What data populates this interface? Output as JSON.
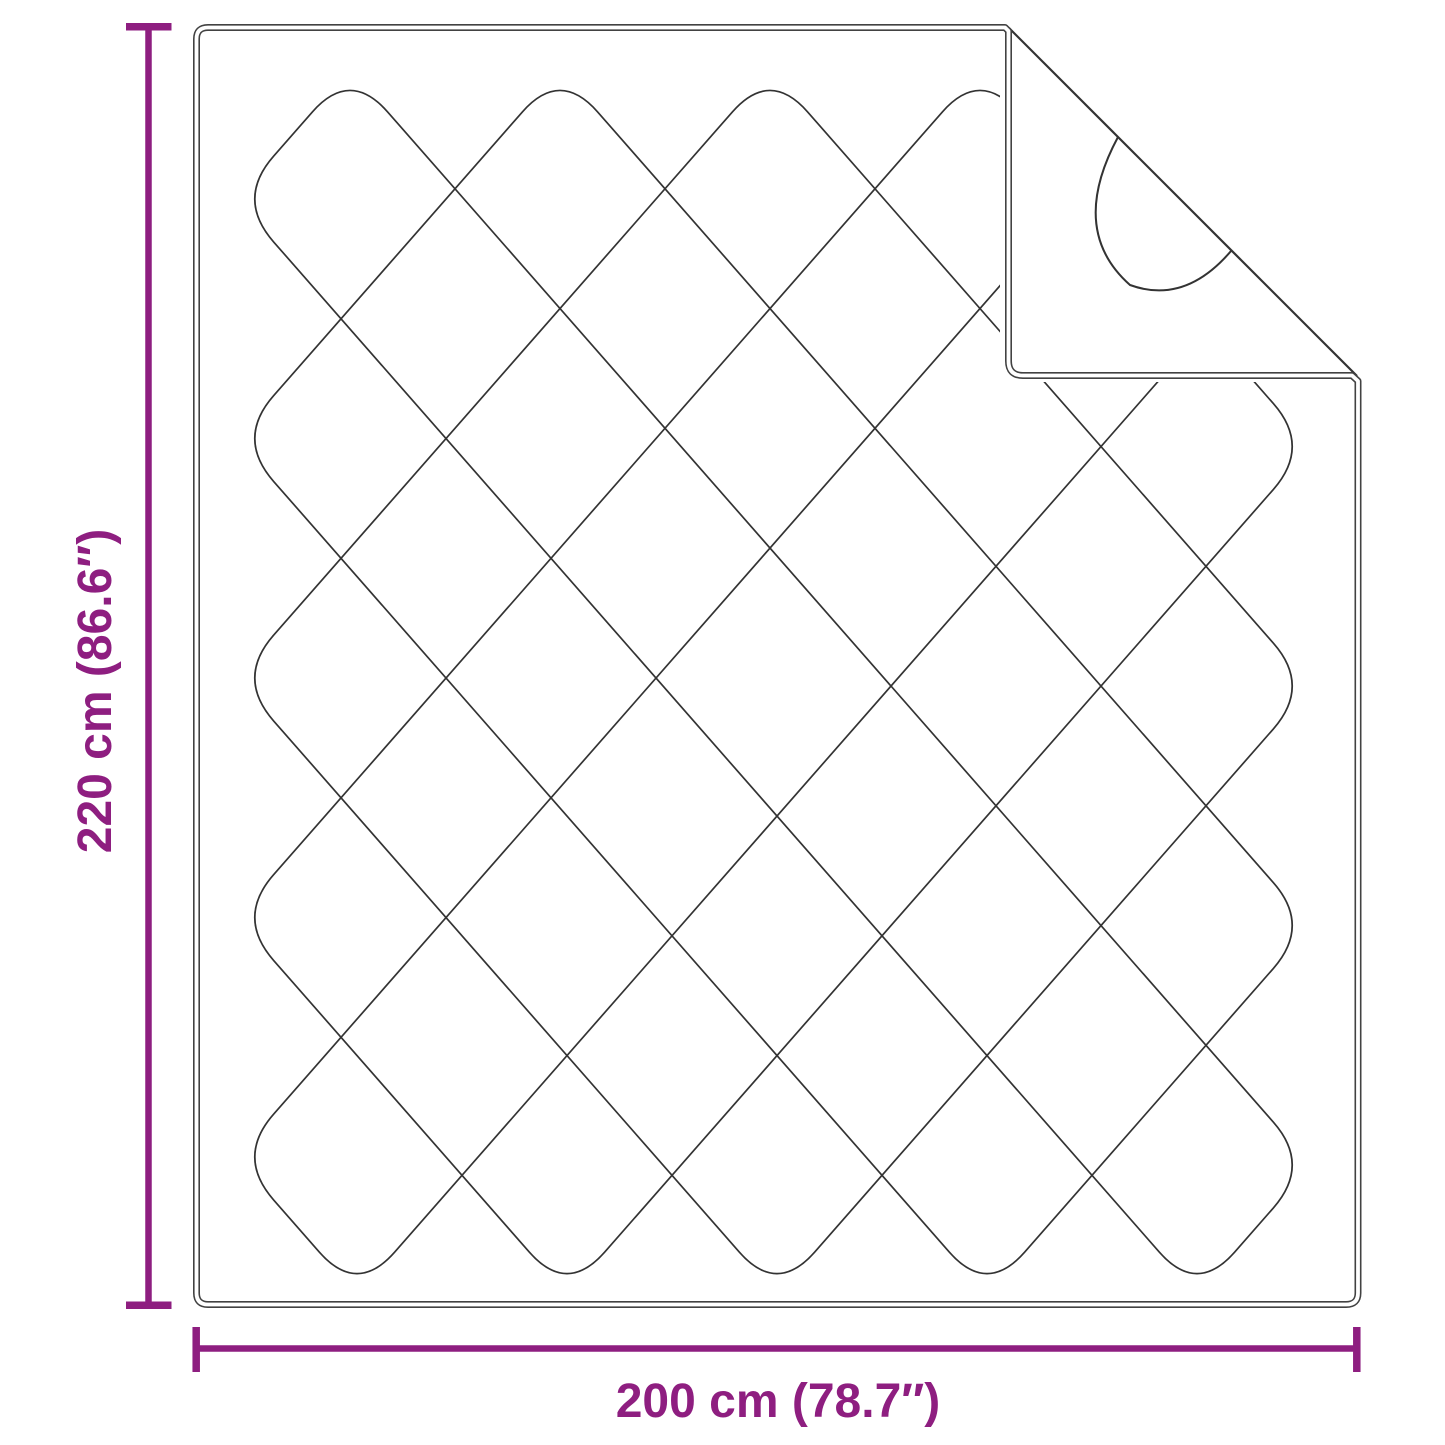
{
  "diagram": {
    "height_dimension": {
      "label": "220 cm (86.6″)"
    },
    "width_dimension": {
      "label": "200 cm (78.7″)"
    }
  },
  "colors": {
    "dimension_accent": "#8E1E80",
    "outline_gray": "#424242",
    "stitch_gray": "#333333",
    "page_bg": "#FFFFFF"
  }
}
